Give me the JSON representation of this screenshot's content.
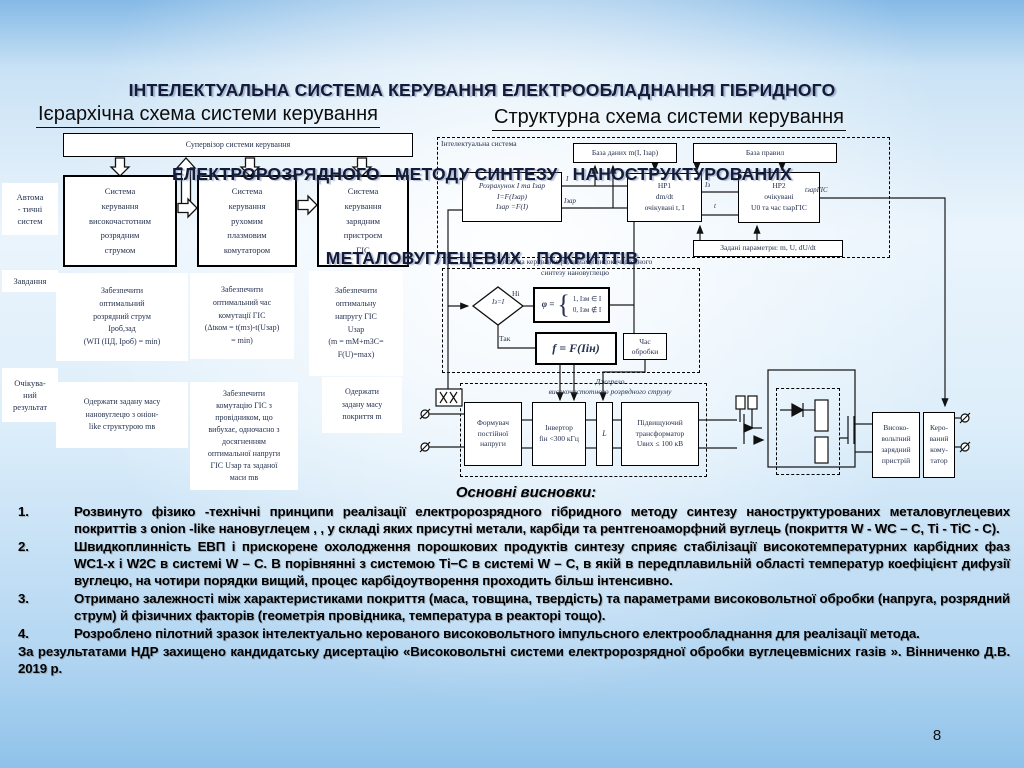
{
  "colors": {
    "title_text": "#141b38",
    "diagram_text": "#26324f",
    "background_edge": "#85b9e6"
  },
  "title": {
    "line1": "ІНТЕЛЕКТУАЛЬНА СИСТЕМА КЕРУВАННЯ ЕЛЕКТРООБЛАДНАННЯ ГІБРИДНОГО",
    "line2": "ЕЛЕКТРОРОЗРЯДНОГО   МЕТОДУ СИНТЕЗУ   НАНОСТРУКТУРОВАНИХ",
    "line3": "МЕТАЛОВУГЛЕЦЕВИХ   ПОКРИТТІВ"
  },
  "left_diagram": {
    "heading": "Ієрархічна схема системи керування",
    "supervisor": "Супервізор системи керування",
    "row_labels": [
      "Автома\n- тичні\nсистем",
      "Завдання",
      "Очікува-\nний\nрезультат"
    ],
    "systems": [
      "Система\nкерування\nвисокочастотним\nрозрядним\nструмом",
      "Система\nкерування\nрухомим\nплазмовим\nкомутатором",
      "Система\nкерування\nзарядним\nпристроєм\nГІС"
    ],
    "tasks": [
      "Забезпечити\nоптимальний\nрозрядний струм\nIроб,зад\n(WП (IІД, Iроб) = min)",
      "Забезпечити\nоптимальний час\nкомутації ГІС\n(Δtком = t(mз)-t(Uзар)\n= min)",
      "Забезпечити\nоптимальну\nнапругу ГІС\nUзар\n(m = mМ+mЗС=\nF(U)=max)"
    ],
    "results": [
      "Одержати задану масу\nнановуглецю з оніон-\nlike структурою mв",
      "Забезпечити\nкомутацію ГІС з\nпровідником, що\nвибухає, одночасно з\nдосягненням\nоптимальної напруги\nГІС Uзар та заданої\nмаси mв",
      "Одержати\nзадану масу\nпокриття m"
    ]
  },
  "right_diagram": {
    "heading": "Структурна схема системи керування",
    "intelligent_system_label": "Інтелектуальна система",
    "database_box": "База даних m(I, Iзар)",
    "rules_box": "База правил",
    "calc_box": "Розрахунок I та Iзар\nI=F(Iзар)\nIзар =F(I)",
    "hp1_box": "НР1\ndm/dt\nочікувані t, I",
    "hp2_box": "НР2\nочікувані\nU0 та час tзарГІС",
    "params_box": "Задані параметри: m, U, dU/dt",
    "control_system_label": "Система керування режимами високочастотного\nсинтезу нановуглецю",
    "decision": "Iз=I",
    "no_label": "Ні",
    "yes_label": "Так",
    "phi_prefix": "φ =",
    "phi_brace": "{",
    "phi_case1": "1, Iзм ∈ I",
    "phi_case2": "0, Iзм ∉ I",
    "f_formula": "f = F(Iін)",
    "time_box": "Час\nобробки",
    "source_label": "Джерело\nвисокочастотного розрядного струму",
    "former_box": "Формувач\nпостійної\nнапруги",
    "inverter_box": "Інвертор\nfін <300 кГц",
    "l_box": "L",
    "transformer_box": "Підвищуючий\nтрансформатор\nUвих ≤ 100 кВ",
    "hv_box": "Високо-\nвольтний\nзарядний\nпристрій",
    "commutator_box": "Керо-\nваний\nкому-\nтатор",
    "wire_labels": {
      "i": "I",
      "izar": "Iзар",
      "iz": "Iз",
      "t": "t",
      "tzar": "tзарГІС"
    }
  },
  "conclusions": {
    "heading": "Основні висновки:",
    "items": [
      {
        "num": "1.",
        "text": "Розвинуто фізико -технічні принципи реалізації  електророзрядного  гібридного методу синтезу  наноструктурованих металовуглецевих  покриттів з  onion -like нановуглецем , , у складі яких присутні метали, карбіди та рентгеноаморфний  вуглець (покриття  W - WC – C, Ti - TiC - C)."
      },
      {
        "num": "2.",
        "text": "Швидкоплинність ЕВП і прискорене охолодження порошкових продуктів синтезу сприяє стабілізації високотемпературних карбідних фаз   WC1-х і W2C в системі  W – С. В порівнянні з системою  Ті−С в системі  W – С, в якій в передплавильній  області температур коефіцієнт дифузії вуглецю, на чотири порядки вищий, процес карбідоутворення  проходить більш інтенсивно."
      },
      {
        "num": "3.",
        "text": "Отримано залежності між характеристиками покриття (маса, товщина, твердість) та параметрами високовольтної обробки (напруга, розрядний струм) й фізичних факторів (геометрія провідника, температура в реакторі тощо)."
      },
      {
        "num": "4.",
        "text": "Розроблено пілотний зразок інтелектуально керованого високовольтного імпульсного електрообладнання для реалізації метода."
      }
    ],
    "footer": "За результатами НДР  захищено  кандидатську  дисертацію  «Високовольтні  системи  електророзрядної  обробки вуглецевмісних  газів ».  Вінниченко  Д.В. 2019 р."
  },
  "page_number": "8"
}
